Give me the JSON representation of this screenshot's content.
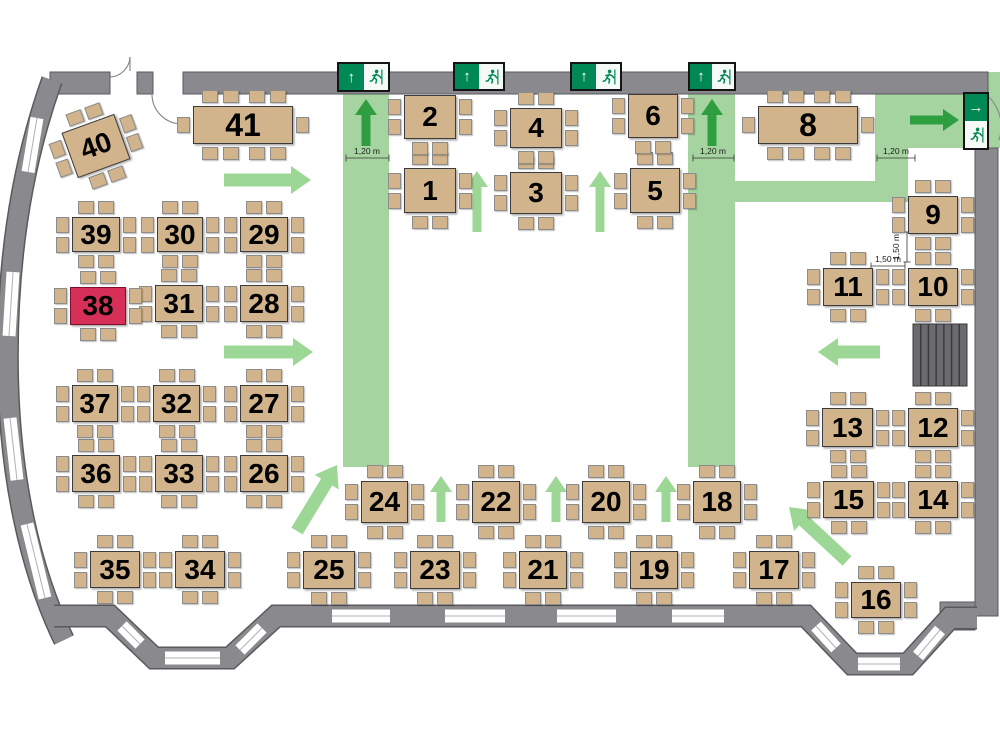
{
  "meta": {
    "type": "room-evacuation-seating-plan",
    "highlighted_table": "38"
  },
  "colors": {
    "wall": "#8a8a8e",
    "wall_outline": "#5a5a5e",
    "floor": "#ffffff",
    "table": "#d2b48c",
    "table_highlight": "#d63058",
    "route": "#a6d4a0",
    "arrow_dark": "#2e9e41",
    "arrow_light": "#9cd795",
    "exit_green": "#008855",
    "stairs": "#6b6b6f"
  },
  "routes": [
    {
      "name": "corridor-left",
      "x": 343,
      "y": 90,
      "w": 46,
      "h": 377
    },
    {
      "name": "corridor-right",
      "x": 688,
      "y": 90,
      "w": 47,
      "h": 377
    },
    {
      "name": "exit-area-top-right",
      "x": 875,
      "y": 90,
      "w": 125,
      "h": 58
    },
    {
      "name": "connector-vertical",
      "x": 875,
      "y": 148,
      "w": 33,
      "h": 54
    },
    {
      "name": "connector-horizontal",
      "x": 735,
      "y": 181,
      "w": 173,
      "h": 21
    },
    {
      "name": "wall-opening-right",
      "x": 988,
      "y": 72,
      "w": 12,
      "h": 22
    }
  ],
  "arrows": [
    {
      "x1": 366,
      "y1": 146,
      "x2": 366,
      "y2": 99,
      "style": "dark",
      "size": "m"
    },
    {
      "x1": 712,
      "y1": 146,
      "x2": 712,
      "y2": 99,
      "style": "dark",
      "size": "m"
    },
    {
      "x1": 910,
      "y1": 120,
      "x2": 959,
      "y2": 120,
      "style": "dark",
      "size": "m"
    },
    {
      "x1": 224,
      "y1": 180,
      "x2": 311,
      "y2": 180,
      "style": "light",
      "size": "l"
    },
    {
      "x1": 224,
      "y1": 352,
      "x2": 313,
      "y2": 352,
      "style": "light",
      "size": "l"
    },
    {
      "x1": 880,
      "y1": 352,
      "x2": 818,
      "y2": 352,
      "style": "light",
      "size": "l"
    },
    {
      "x1": 477,
      "y1": 232,
      "x2": 477,
      "y2": 171,
      "style": "light",
      "size": "m"
    },
    {
      "x1": 600,
      "y1": 232,
      "x2": 600,
      "y2": 171,
      "style": "light",
      "size": "m"
    },
    {
      "x1": 441,
      "y1": 522,
      "x2": 441,
      "y2": 476,
      "style": "light",
      "size": "m"
    },
    {
      "x1": 556,
      "y1": 522,
      "x2": 556,
      "y2": 476,
      "style": "light",
      "size": "m"
    },
    {
      "x1": 666,
      "y1": 522,
      "x2": 666,
      "y2": 476,
      "style": "light",
      "size": "m"
    },
    {
      "x1": 297,
      "y1": 531,
      "x2": 337,
      "y2": 465,
      "style": "light",
      "size": "l"
    },
    {
      "x1": 847,
      "y1": 561,
      "x2": 789,
      "y2": 507,
      "style": "light",
      "size": "l"
    }
  ],
  "exit_signs": [
    {
      "name": "exit-sign-1",
      "x": 337,
      "y": 62,
      "w": 53,
      "h": 30,
      "orient": "h",
      "arrow": "up"
    },
    {
      "name": "exit-sign-2",
      "x": 453,
      "y": 62,
      "w": 52,
      "h": 29,
      "orient": "h",
      "arrow": "up"
    },
    {
      "name": "exit-sign-3",
      "x": 570,
      "y": 62,
      "w": 52,
      "h": 29,
      "orient": "h",
      "arrow": "up"
    },
    {
      "name": "exit-sign-4",
      "x": 688,
      "y": 62,
      "w": 48,
      "h": 29,
      "orient": "h",
      "arrow": "up"
    },
    {
      "name": "exit-sign-right",
      "x": 963,
      "y": 92,
      "w": 26,
      "h": 58,
      "orient": "v",
      "arrow": "right"
    }
  ],
  "dimension_labels": [
    {
      "text": "1,20 m",
      "tx": 367,
      "ty": 154,
      "rot": 0,
      "line": [
        346,
        158,
        389,
        158
      ]
    },
    {
      "text": "1,20 m",
      "tx": 713,
      "ty": 154,
      "rot": 0,
      "line": [
        693,
        158,
        734,
        158
      ]
    },
    {
      "text": "1,20 m",
      "tx": 896,
      "ty": 154,
      "rot": 0,
      "line": [
        877,
        158,
        915,
        158
      ]
    },
    {
      "text": "1,50 m",
      "tx": 888,
      "ty": 262,
      "rot": 0,
      "line": [
        871,
        266,
        905,
        266
      ]
    },
    {
      "text": "1,50 m",
      "tx": 899,
      "ty": 247,
      "rot": -90,
      "line": [
        907,
        232,
        907,
        262
      ]
    }
  ],
  "stairs": {
    "x": 913,
    "y": 324,
    "w": 54,
    "h": 62,
    "steps": 6
  },
  "tables": [
    {
      "n": "1",
      "x": 404,
      "y": 168,
      "w": 52,
      "h": 45,
      "type": "s8"
    },
    {
      "n": "2",
      "x": 404,
      "y": 95,
      "w": 52,
      "h": 44,
      "type": "s6"
    },
    {
      "n": "3",
      "x": 510,
      "y": 172,
      "w": 52,
      "h": 42,
      "type": "s8"
    },
    {
      "n": "4",
      "x": 510,
      "y": 108,
      "w": 52,
      "h": 40,
      "type": "s8"
    },
    {
      "n": "5",
      "x": 630,
      "y": 168,
      "w": 50,
      "h": 45,
      "type": "s8"
    },
    {
      "n": "6",
      "x": 628,
      "y": 94,
      "w": 50,
      "h": 44,
      "type": "s6"
    },
    {
      "n": "8",
      "x": 758,
      "y": 106,
      "w": 100,
      "h": 38,
      "type": "long"
    },
    {
      "n": "9",
      "x": 908,
      "y": 196,
      "w": 50,
      "h": 38,
      "type": "s8"
    },
    {
      "n": "10",
      "x": 908,
      "y": 268,
      "w": 50,
      "h": 38,
      "type": "s8"
    },
    {
      "n": "11",
      "x": 823,
      "y": 268,
      "w": 50,
      "h": 38,
      "type": "s8"
    },
    {
      "n": "12",
      "x": 908,
      "y": 408,
      "w": 50,
      "h": 39,
      "type": "s8"
    },
    {
      "n": "13",
      "x": 822,
      "y": 408,
      "w": 51,
      "h": 39,
      "type": "s8"
    },
    {
      "n": "14",
      "x": 908,
      "y": 481,
      "w": 50,
      "h": 37,
      "type": "s8"
    },
    {
      "n": "15",
      "x": 823,
      "y": 481,
      "w": 51,
      "h": 37,
      "type": "s8"
    },
    {
      "n": "16",
      "x": 851,
      "y": 582,
      "w": 50,
      "h": 36,
      "type": "s8"
    },
    {
      "n": "17",
      "x": 749,
      "y": 551,
      "w": 50,
      "h": 38,
      "type": "s8"
    },
    {
      "n": "18",
      "x": 693,
      "y": 481,
      "w": 48,
      "h": 42,
      "type": "s8"
    },
    {
      "n": "19",
      "x": 630,
      "y": 551,
      "w": 48,
      "h": 38,
      "type": "s8"
    },
    {
      "n": "20",
      "x": 582,
      "y": 481,
      "w": 48,
      "h": 42,
      "type": "s8"
    },
    {
      "n": "21",
      "x": 519,
      "y": 551,
      "w": 48,
      "h": 38,
      "type": "s8"
    },
    {
      "n": "22",
      "x": 472,
      "y": 481,
      "w": 48,
      "h": 42,
      "type": "s8"
    },
    {
      "n": "23",
      "x": 410,
      "y": 551,
      "w": 50,
      "h": 38,
      "type": "s8"
    },
    {
      "n": "24",
      "x": 361,
      "y": 481,
      "w": 47,
      "h": 42,
      "type": "s8"
    },
    {
      "n": "25",
      "x": 303,
      "y": 551,
      "w": 52,
      "h": 38,
      "type": "s8"
    },
    {
      "n": "26",
      "x": 240,
      "y": 455,
      "w": 48,
      "h": 37,
      "type": "s8"
    },
    {
      "n": "27",
      "x": 240,
      "y": 385,
      "w": 48,
      "h": 37,
      "type": "s8"
    },
    {
      "n": "28",
      "x": 240,
      "y": 285,
      "w": 48,
      "h": 37,
      "type": "s8"
    },
    {
      "n": "29",
      "x": 240,
      "y": 217,
      "w": 48,
      "h": 35,
      "type": "s8"
    },
    {
      "n": "30",
      "x": 157,
      "y": 217,
      "w": 46,
      "h": 35,
      "type": "s8"
    },
    {
      "n": "31",
      "x": 155,
      "y": 285,
      "w": 48,
      "h": 37,
      "type": "s8"
    },
    {
      "n": "32",
      "x": 153,
      "y": 385,
      "w": 47,
      "h": 37,
      "type": "s8"
    },
    {
      "n": "33",
      "x": 155,
      "y": 455,
      "w": 48,
      "h": 37,
      "type": "s8"
    },
    {
      "n": "34",
      "x": 175,
      "y": 551,
      "w": 50,
      "h": 37,
      "type": "s8"
    },
    {
      "n": "35",
      "x": 90,
      "y": 551,
      "w": 50,
      "h": 37,
      "type": "s8"
    },
    {
      "n": "36",
      "x": 72,
      "y": 455,
      "w": 48,
      "h": 37,
      "type": "s8"
    },
    {
      "n": "37",
      "x": 72,
      "y": 385,
      "w": 46,
      "h": 37,
      "type": "s8"
    },
    {
      "n": "38",
      "x": 70,
      "y": 287,
      "w": 56,
      "h": 38,
      "type": "s8",
      "highlight": true
    },
    {
      "n": "39",
      "x": 72,
      "y": 217,
      "w": 48,
      "h": 35,
      "type": "s8"
    },
    {
      "n": "40",
      "x": 68,
      "y": 122,
      "w": 56,
      "h": 48,
      "type": "s8",
      "rot": -20
    },
    {
      "n": "41",
      "x": 193,
      "y": 106,
      "w": 100,
      "h": 38,
      "type": "long"
    }
  ]
}
